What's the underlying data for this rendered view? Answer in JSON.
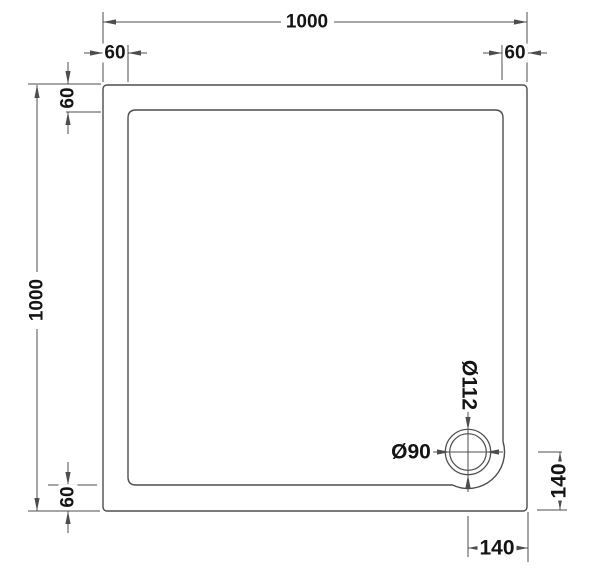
{
  "meta": {
    "description": "Square shower tray plan technical drawing with waste drain in bottom-right corner",
    "units": "mm"
  },
  "palette": {
    "line_color": "#4d4d4d",
    "text_color": "#141414",
    "background": "#ffffff"
  },
  "labels": {
    "overall_width_top": "1000",
    "overall_depth_left": "1000",
    "flange_top_left": "60",
    "flange_top_right": "60",
    "flange_left_top": "60",
    "flange_left_bottom": "60",
    "waste_outer_diameter": "Ø112",
    "waste_inner_diameter": "Ø90",
    "waste_offset_from_right": "140",
    "waste_offset_from_bottom": "140"
  }
}
